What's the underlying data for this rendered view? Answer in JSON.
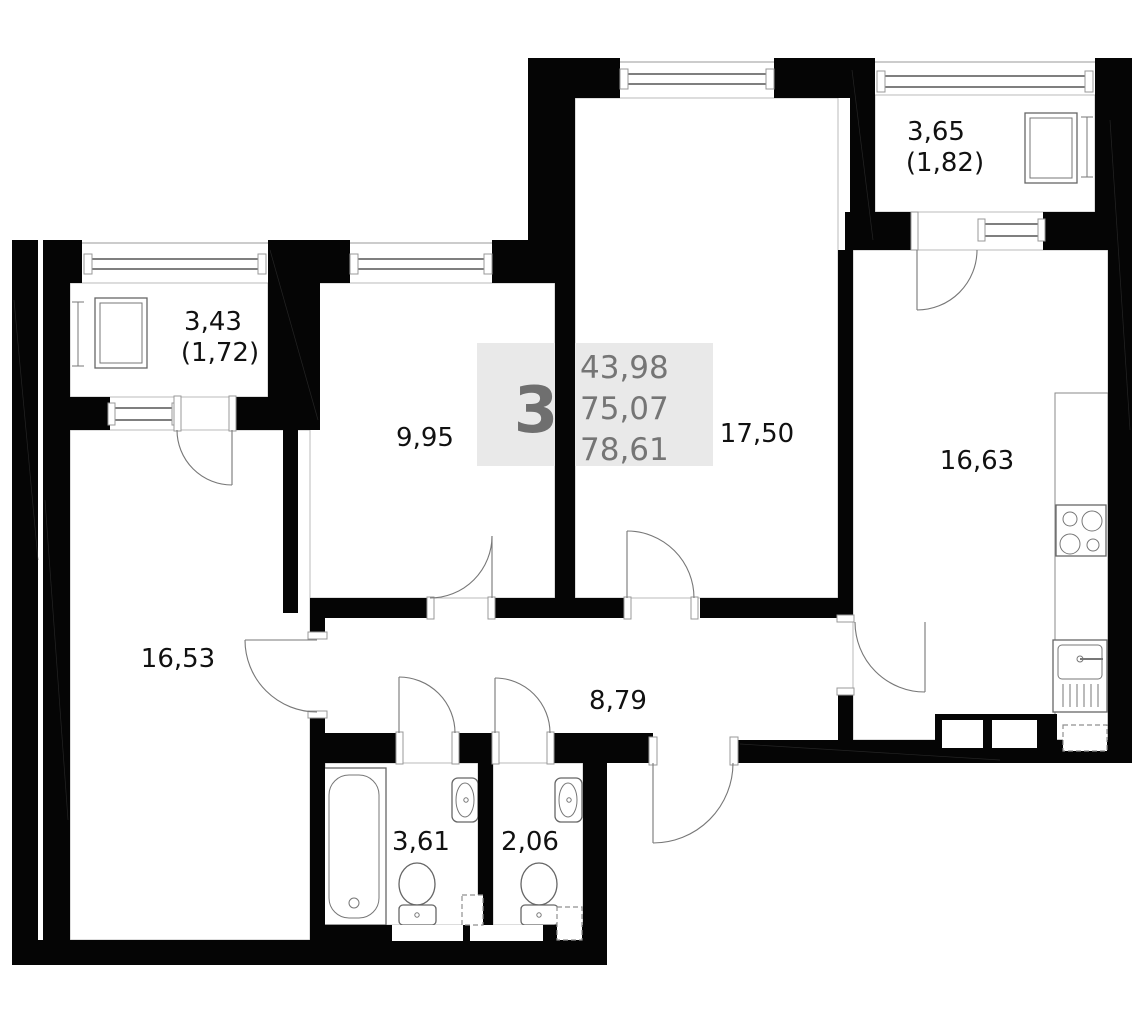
{
  "plan": {
    "summary": {
      "rooms_count": "3",
      "area_living": "43,98",
      "area_usable": "75,07",
      "area_total": "78,61"
    },
    "rooms": {
      "balcony_left": {
        "area": "3,43",
        "area_reduced": "(1,72)"
      },
      "balcony_right": {
        "area": "3,65",
        "area_reduced": "(1,82)"
      },
      "bedroom": {
        "area": "9,95"
      },
      "living_room": {
        "area": "17,50"
      },
      "kitchen": {
        "area": "16,63"
      },
      "bedroom_large": {
        "area": "16,53"
      },
      "hallway": {
        "area": "8,79"
      },
      "bathroom": {
        "area": "3,61"
      },
      "toilet": {
        "area": "2,06"
      }
    },
    "colors": {
      "wall": "#050505",
      "fixture_line": "#666666",
      "summary_bg": "#e9e9e9",
      "summary_text": "#757575",
      "label_text": "#111111"
    }
  }
}
